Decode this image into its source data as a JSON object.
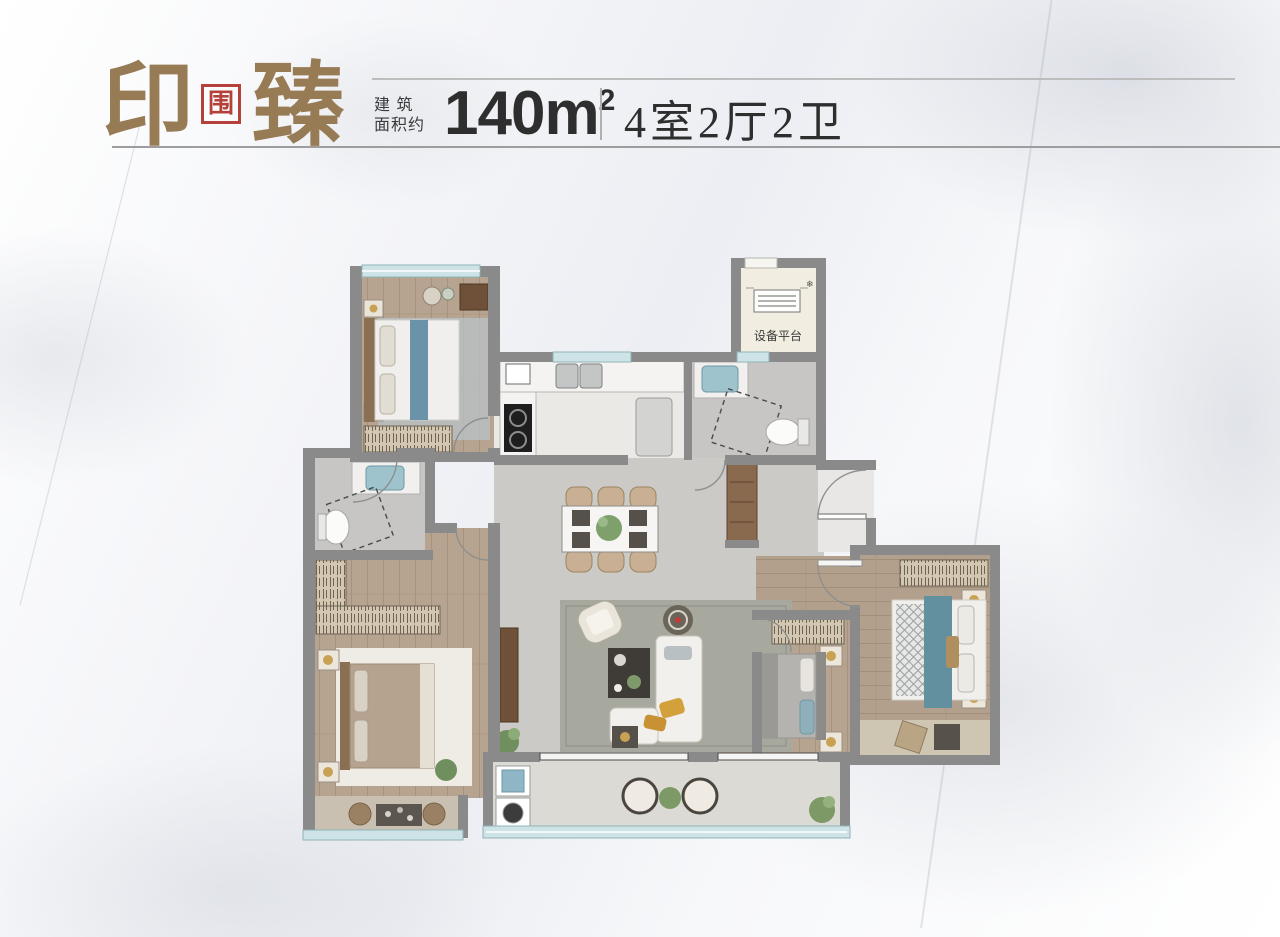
{
  "header": {
    "title_left": "印",
    "seal_char": "围",
    "title_right": "臻",
    "area_label_line1": "建 筑",
    "area_label_line2": "面积约",
    "area_value": "140m",
    "area_sup": "2",
    "layout_text": "4室2厅2卫"
  },
  "floorplan": {
    "equipment_platform_label": "设备平台"
  },
  "colors": {
    "title_brown": "#977b55",
    "seal_red": "#b5423a",
    "text_dark": "#2e2e2e",
    "wall_gray": "#8a8a8a",
    "window_teal": "#cde3e6",
    "wood_floor": "#b6a390",
    "tile_gray": "#cbcac7",
    "bath_tile": "#c7c6c4",
    "equipment_floor": "#f1eee1",
    "rug_green": "#a7a99f",
    "bed_teal": "#62909e",
    "pillow_yellow": "#d3a13c"
  }
}
